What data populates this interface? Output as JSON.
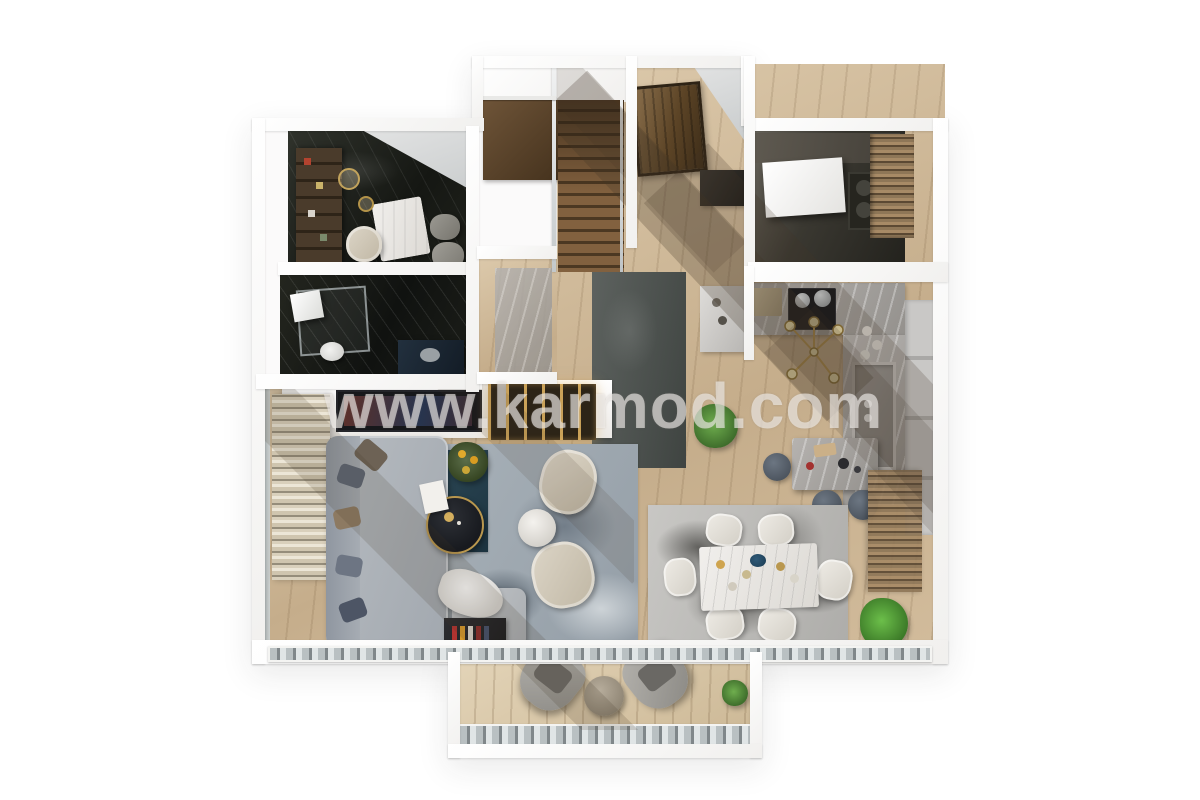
{
  "watermark": {
    "text": "www.karmod.com"
  },
  "scene": {
    "description": "3D rendered top-down dollhouse floor plan of an apartment ground floor",
    "background": "#ffffff",
    "rooms": [
      {
        "name": "study",
        "floor": "black-marble",
        "items": [
          "bookshelf-wall",
          "white-marble-desk",
          "cream-tub-chair",
          "grey-guest-chairs",
          "pendant-lamps"
        ]
      },
      {
        "name": "bathroom",
        "floor": "black-marble",
        "items": [
          "glass-shower",
          "toilet",
          "dark-vanity-basin"
        ]
      },
      {
        "name": "stair-hall",
        "floor": "oak",
        "items": [
          "l-shaped-wood-stair",
          "landing",
          "glass-balustrade"
        ]
      },
      {
        "name": "entry",
        "floor": "oak",
        "items": [
          "wood-entrance-door",
          "dark-console"
        ]
      },
      {
        "name": "utility-room",
        "floor": "dark-stone",
        "items": [
          "counter",
          "appliances",
          "louvered-wardrobe",
          "white-table"
        ]
      },
      {
        "name": "kitchen",
        "floor": "oak",
        "items": [
          "grey-marble-counter",
          "cooktop-with-pots",
          "double-sink",
          "tall-cabinets",
          "marble-island",
          "bar-stools",
          "brass-chandelier",
          "glass-jars"
        ]
      },
      {
        "name": "hallway",
        "floor": "oak",
        "items": [
          "dark-runner-rug",
          "marble-runner",
          "console-table",
          "potted-plant"
        ]
      },
      {
        "name": "living-room",
        "floor": "oak",
        "items": [
          "grey-sectional-sofa",
          "throw-pillows",
          "ottoman-with-blanket",
          "round-dark-coffee-table",
          "teal-accent-rug",
          "patterned-grey-rug",
          "cream-armchairs",
          "round-side-table",
          "tv-wall-backlit-shelving",
          "media-console-books",
          "striped-curtains",
          "yellow-flower-arrangement"
        ]
      },
      {
        "name": "dining-room",
        "floor": "oak",
        "items": [
          "white-marble-dining-table",
          "six-white-chairs",
          "abstract-grey-rug",
          "blue-centerpiece-bowl",
          "potted-plant",
          "louvered-blinds"
        ]
      },
      {
        "name": "balcony",
        "floor": "deck-wood",
        "items": [
          "two-grey-lounge-chairs",
          "round-side-table",
          "glass-railing",
          "small-plant"
        ]
      }
    ],
    "palette": {
      "background": "#ffffff",
      "walls": "#f7f6f4",
      "oak_floor": "#cdb492",
      "dark_marble": "#1d1f1c",
      "grey_marble": "#a8a5a2",
      "sofa_grey": "#aeb3b9",
      "cream_fabric": "#d8d1c3",
      "teal_rug": "#2a4450",
      "stair_wood": "#77593b",
      "door_wood": "#4a3826",
      "plant_green": "#4e7d3a",
      "brass_accent": "#b9974e"
    }
  }
}
